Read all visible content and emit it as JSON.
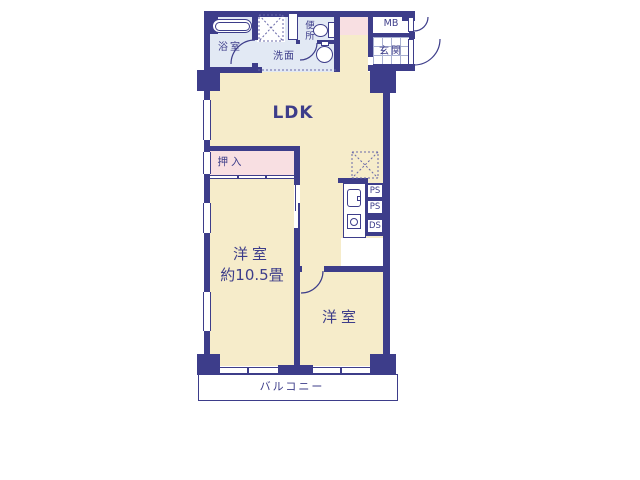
{
  "colors": {
    "wall": "#3d3d8a",
    "floor_cream": "#f6ecca",
    "floor_pink": "#f8dfe2",
    "floor_wet": "#e2e9f4",
    "floor_white": "#ffffff",
    "dash_line": "#6868a8"
  },
  "floor_plan": {
    "ldk_label": "LDK",
    "bathroom_label": "浴室",
    "washroom_label": "洗面",
    "toilet_label": "便所",
    "entrance_label": "玄関",
    "meter_box_label": "MB",
    "closet_label": "押入",
    "bedroom1_label": "洋室",
    "bedroom1_size": "約10.5畳",
    "bedroom2_label": "洋室",
    "pipe_shaft_labels": [
      "PS",
      "PS",
      "DS"
    ],
    "balcony_label": "バルコニー"
  }
}
